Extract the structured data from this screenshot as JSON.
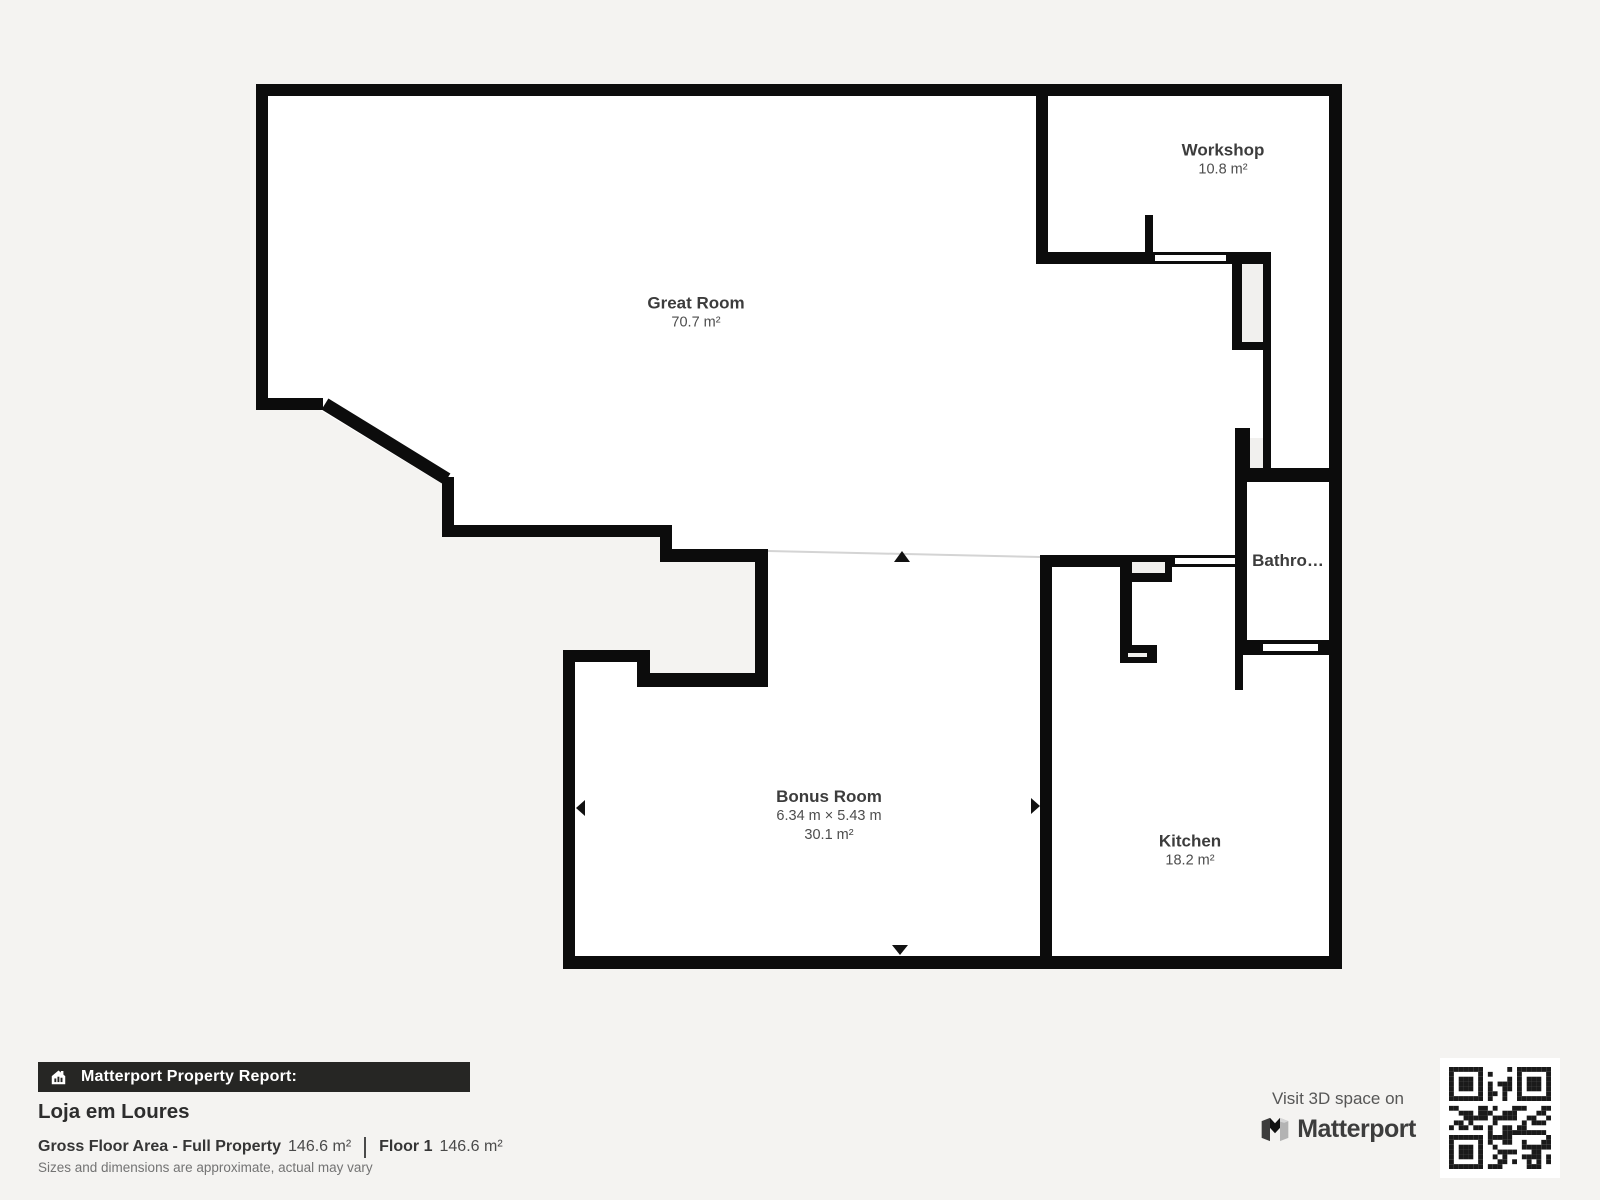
{
  "background": "#f4f3f1",
  "floorplan": {
    "wall_color": "#0c0c0c",
    "floor_color": "#ffffff",
    "open_boundary_color": "#d4d4d4",
    "rooms": {
      "great_room": {
        "name": "Great Room",
        "area": "70.7 m²"
      },
      "workshop": {
        "name": "Workshop",
        "area": "10.8 m²"
      },
      "bathroom": {
        "name": "Bathro…"
      },
      "bonus_room": {
        "name": "Bonus Room",
        "dimensions": "6.34 m × 5.43 m",
        "area": "30.1 m²"
      },
      "kitchen": {
        "name": "Kitchen",
        "area": "18.2 m²"
      }
    }
  },
  "report": {
    "banner_title": "Matterport Property Report:",
    "property_name": "Loja em Loures",
    "gross_floor_area_label": "Gross Floor Area - Full Property",
    "gross_floor_area_value": "146.6 m²",
    "floor_label": "Floor 1",
    "floor_value": "146.6 m²",
    "disclaimer": "Sizes and dimensions are approximate, actual may vary"
  },
  "promo": {
    "visit_label": "Visit 3D space on",
    "brand_name": "Matterport"
  }
}
